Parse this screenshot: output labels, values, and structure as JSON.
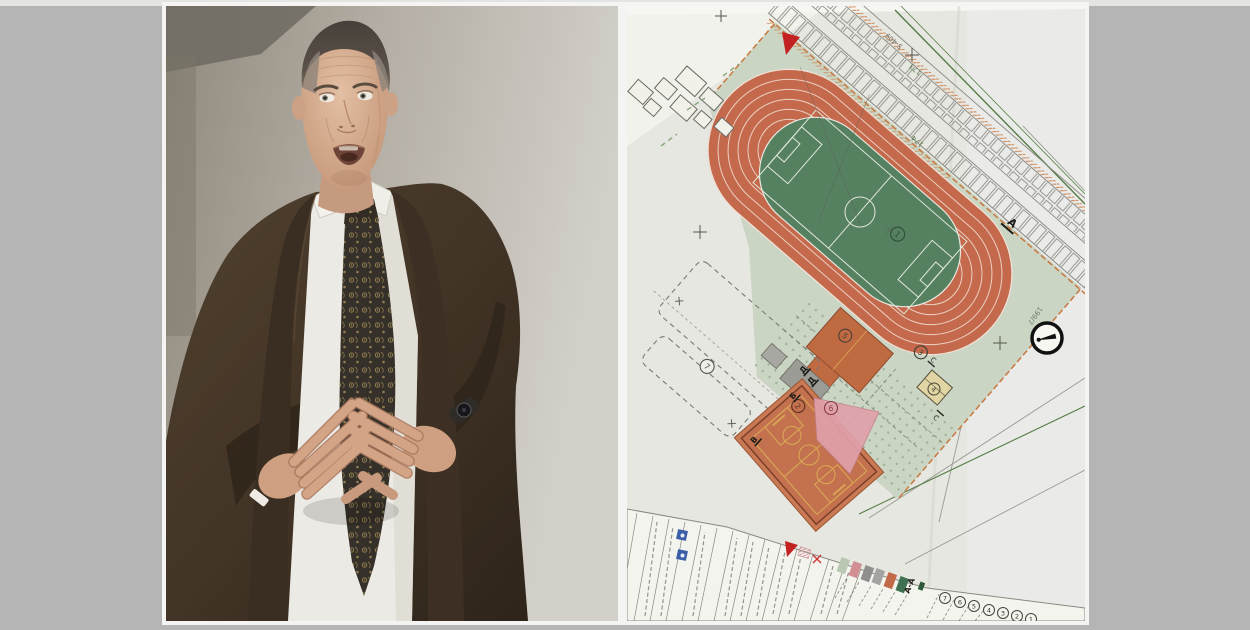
{
  "frame": {
    "background": "#b5b5b5",
    "top_strip": "#e4e4e2",
    "photo_border": "#f4f4f2"
  },
  "left_photo": {
    "description": "Man in a dark brown suit, white shirt and black-and-gold paisley tie, short faded haircut, speaking with fingertips steepled in front of his chest, dark wristwatch, plain grey wall behind",
    "colors": {
      "wall": "#b3ada3",
      "suit": "#45362a",
      "shirt": "#eceae4",
      "tie": "#36302a",
      "tie_pattern": "#b19a5e",
      "skin": "#d6ae93"
    }
  },
  "right_photo": {
    "description": "Tilted photo of an architectural site plan of a sports complex: oval running track with football pitch, courts, landscaping, parking rows, title block and legend",
    "labels": {
      "areas": [
        "1",
        "2",
        "3",
        "4",
        "5",
        "6",
        "7"
      ],
      "legend_row": [
        "7",
        "6",
        "5",
        "4",
        "3",
        "2",
        "1"
      ],
      "section_cut": "А",
      "section_letters": [
        "Д",
        "Д",
        "Б",
        "В",
        "С",
        "С"
      ],
      "legend_section": "А-А",
      "parcels": {
        "p173": "173",
        "p174": "174",
        "p199": "199/7",
        "road": "5-409"
      }
    },
    "legend_colors": [
      "#b9c8b2",
      "#d18f94",
      "#8f8f8d",
      "#a3a3a1",
      "#c26a48",
      "#3f7152"
    ],
    "palette": {
      "paper": "#e7e7e1",
      "track": "#c5694c",
      "infield": "#568160",
      "site_green": "#cbd5c3",
      "court_orange": "#c3714e",
      "court_lines": "#d9a855",
      "pink_area": "#dfa0aa",
      "building_beige": "#e2d5a4",
      "north_arrow": "#111111",
      "stamp_blue": "#3b5ea8",
      "marker_red": "#c32222",
      "boundary_green": "#567d46"
    }
  }
}
